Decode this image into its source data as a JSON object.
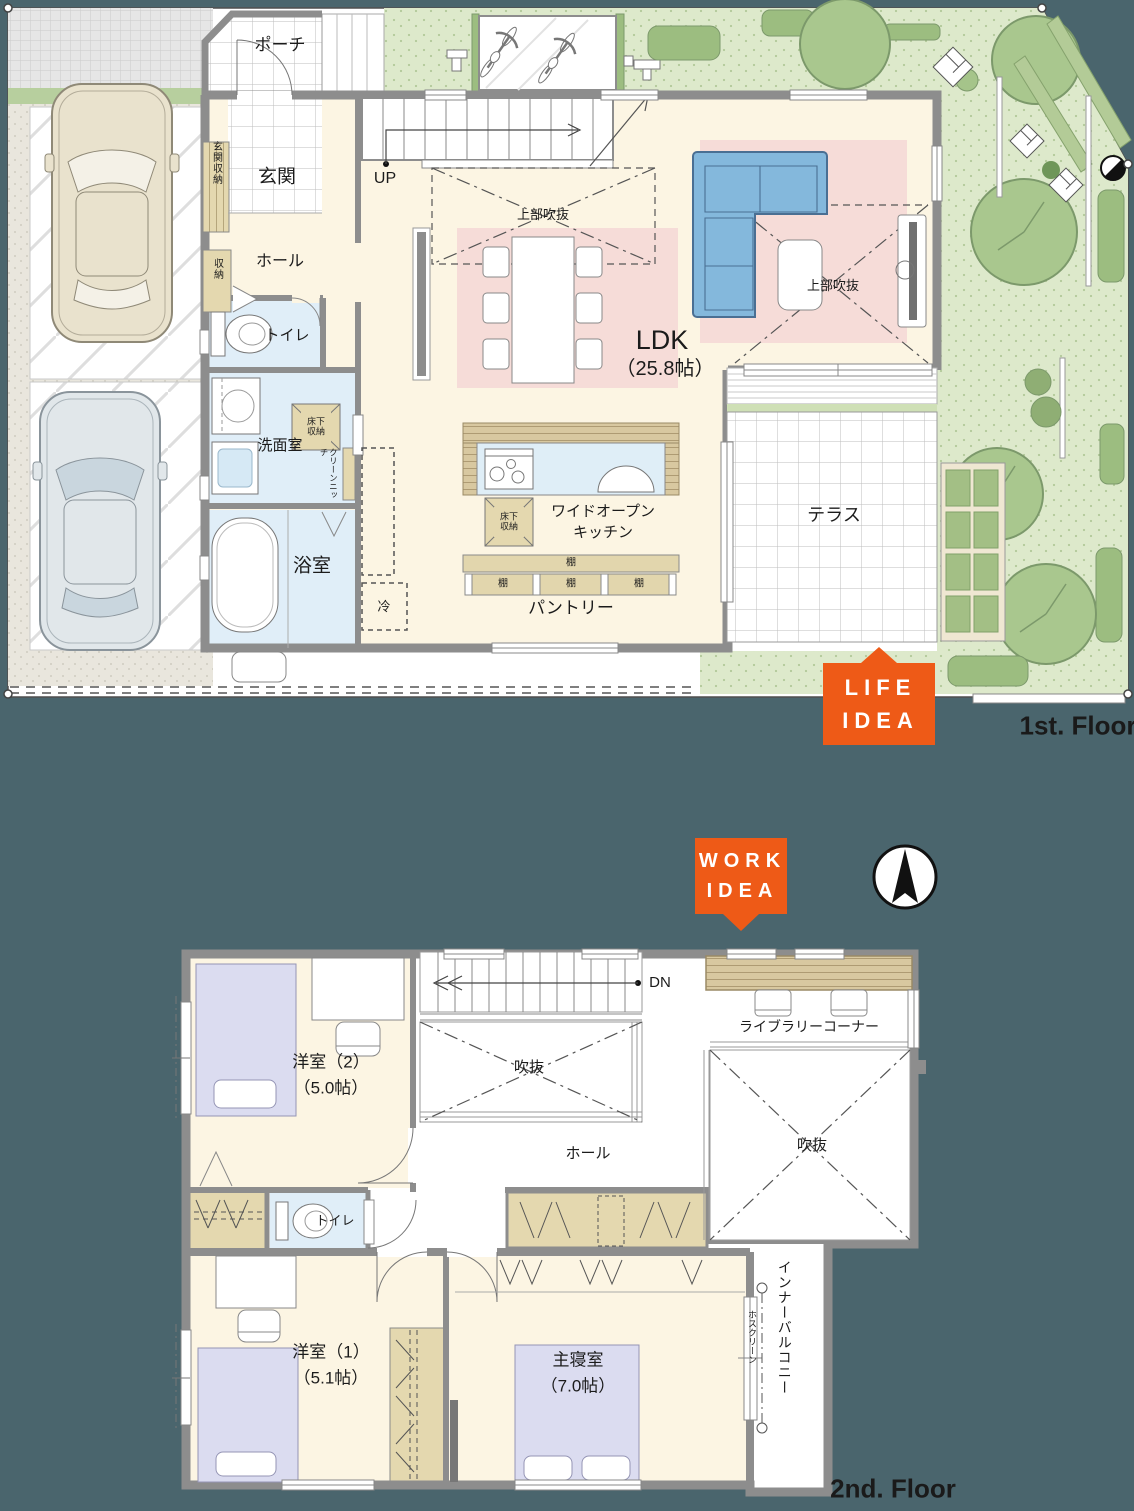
{
  "page": {
    "floor1_caption": "1st. Floor",
    "floor2_caption": "2nd. Floor"
  },
  "badges": {
    "life_idea": {
      "line1": "LIFE",
      "line2": "IDEA"
    },
    "work_idea": {
      "line1": "WORK",
      "line2": "IDEA"
    }
  },
  "floor1": {
    "porch": "ポーチ",
    "entrance": "玄関",
    "entrance_storage": "玄関収納",
    "storage": "収納",
    "hall": "ホール",
    "toilet": "トイレ",
    "washroom": "洗面室",
    "underfloor_storage": "床下収納",
    "clean_niche": "クリーンニッチ",
    "bathroom": "浴室",
    "stairs_up": "UP",
    "upper_void": "上部吹抜",
    "ldk_name": "LDK",
    "ldk_size": "（25.8帖）",
    "kitchen_line1": "ワイドオープン",
    "kitchen_line2": "キッチン",
    "shelf": "棚",
    "pantry": "パントリー",
    "fridge": "冷",
    "terrace": "テラス"
  },
  "floor2": {
    "western_room2_name": "洋室（2）",
    "western_room2_size": "（5.0帖）",
    "stairs_down": "DN",
    "void": "吹抜",
    "library_corner": "ライブラリーコーナー",
    "hall": "ホール",
    "toilet": "トイレ",
    "western_room1_name": "洋室（1）",
    "western_room1_size": "（5.1帖）",
    "master_bedroom_name": "主寝室",
    "master_bedroom_size": "（7.0帖）",
    "inner_balcony": "インナーバルコニー",
    "drying_pole": "ホスクリーン"
  },
  "icons": {
    "compass": "north-arrow-compass",
    "life_pointer": "triangle-up",
    "work_pointer": "triangle-down"
  },
  "colors": {
    "background_teal": "#4a656d",
    "accent_orange": "#ee5a17",
    "floor_cream": "#fcf5e3",
    "rug_pink": "#f6dcd8",
    "wet_room_blue": "#e0eef8",
    "storage_tan": "#e4d8af",
    "wall_gray": "#8d8d8d",
    "garden_green": "#dde9cb",
    "sofa_blue": "#84b8dc",
    "bed_lavender": "#dbdcf0"
  }
}
